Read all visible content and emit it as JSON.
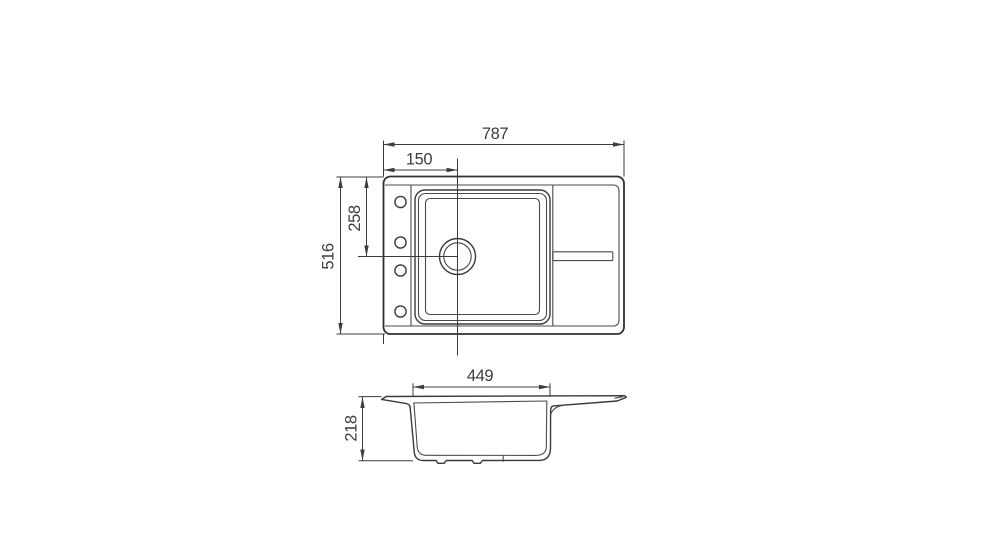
{
  "drawing": {
    "type": "sink-technical-drawing",
    "background": "#ffffff",
    "line_color": "#3c3c3c",
    "text_color": "#3c3c3c",
    "dimensions": {
      "overall_width": "787",
      "drain_offset": "150",
      "drain_from_top": "258",
      "overall_depth": "516",
      "bowl_width": "449",
      "bowl_depth": "218"
    }
  }
}
